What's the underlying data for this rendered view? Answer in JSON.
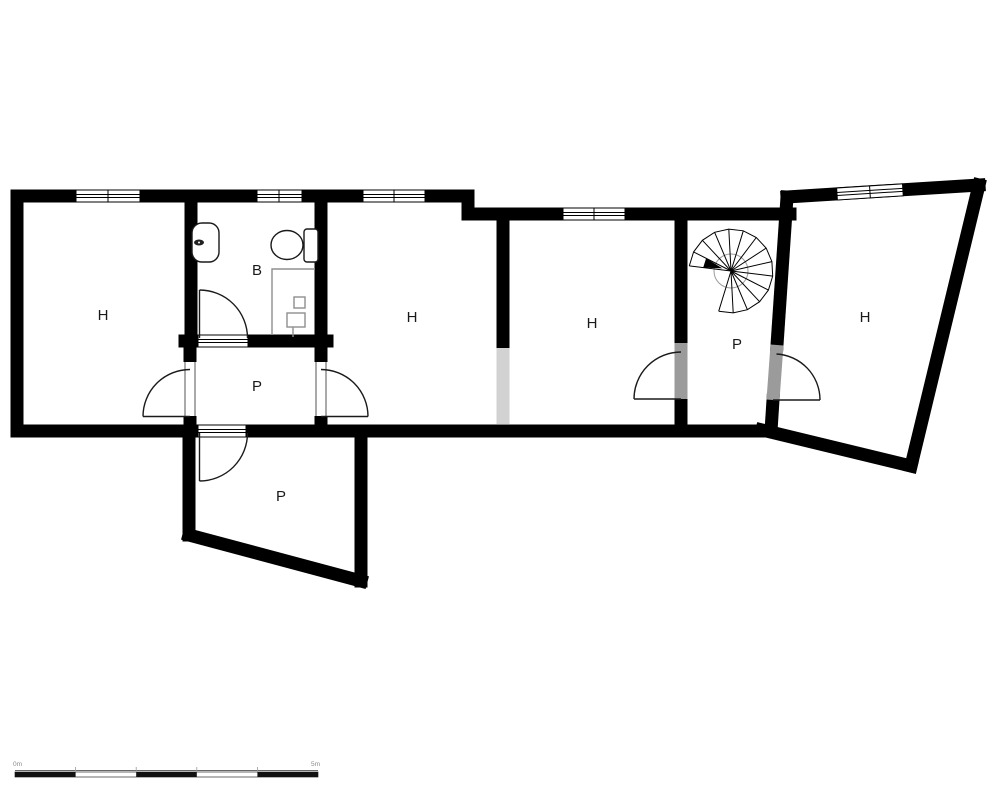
{
  "plan": {
    "rooms": [
      {
        "name": "room-h-left",
        "label": "H"
      },
      {
        "name": "bathroom",
        "label": "B"
      },
      {
        "name": "room-h-middle",
        "label": "H"
      },
      {
        "name": "room-h-mid-right",
        "label": "H"
      },
      {
        "name": "stair-hall",
        "label": "P"
      },
      {
        "name": "room-h-tilted",
        "label": "H"
      },
      {
        "name": "hallway",
        "label": "P"
      },
      {
        "name": "room-p-lower",
        "label": "P"
      }
    ],
    "scale_bar": {
      "start_label": "0m",
      "end_label": "5m"
    },
    "colors": {
      "wall": "#000000",
      "open_passage": "#d2d2d2",
      "door_threshold": "#9b9b9b",
      "fixture_outline": "#8f8f8f"
    }
  }
}
